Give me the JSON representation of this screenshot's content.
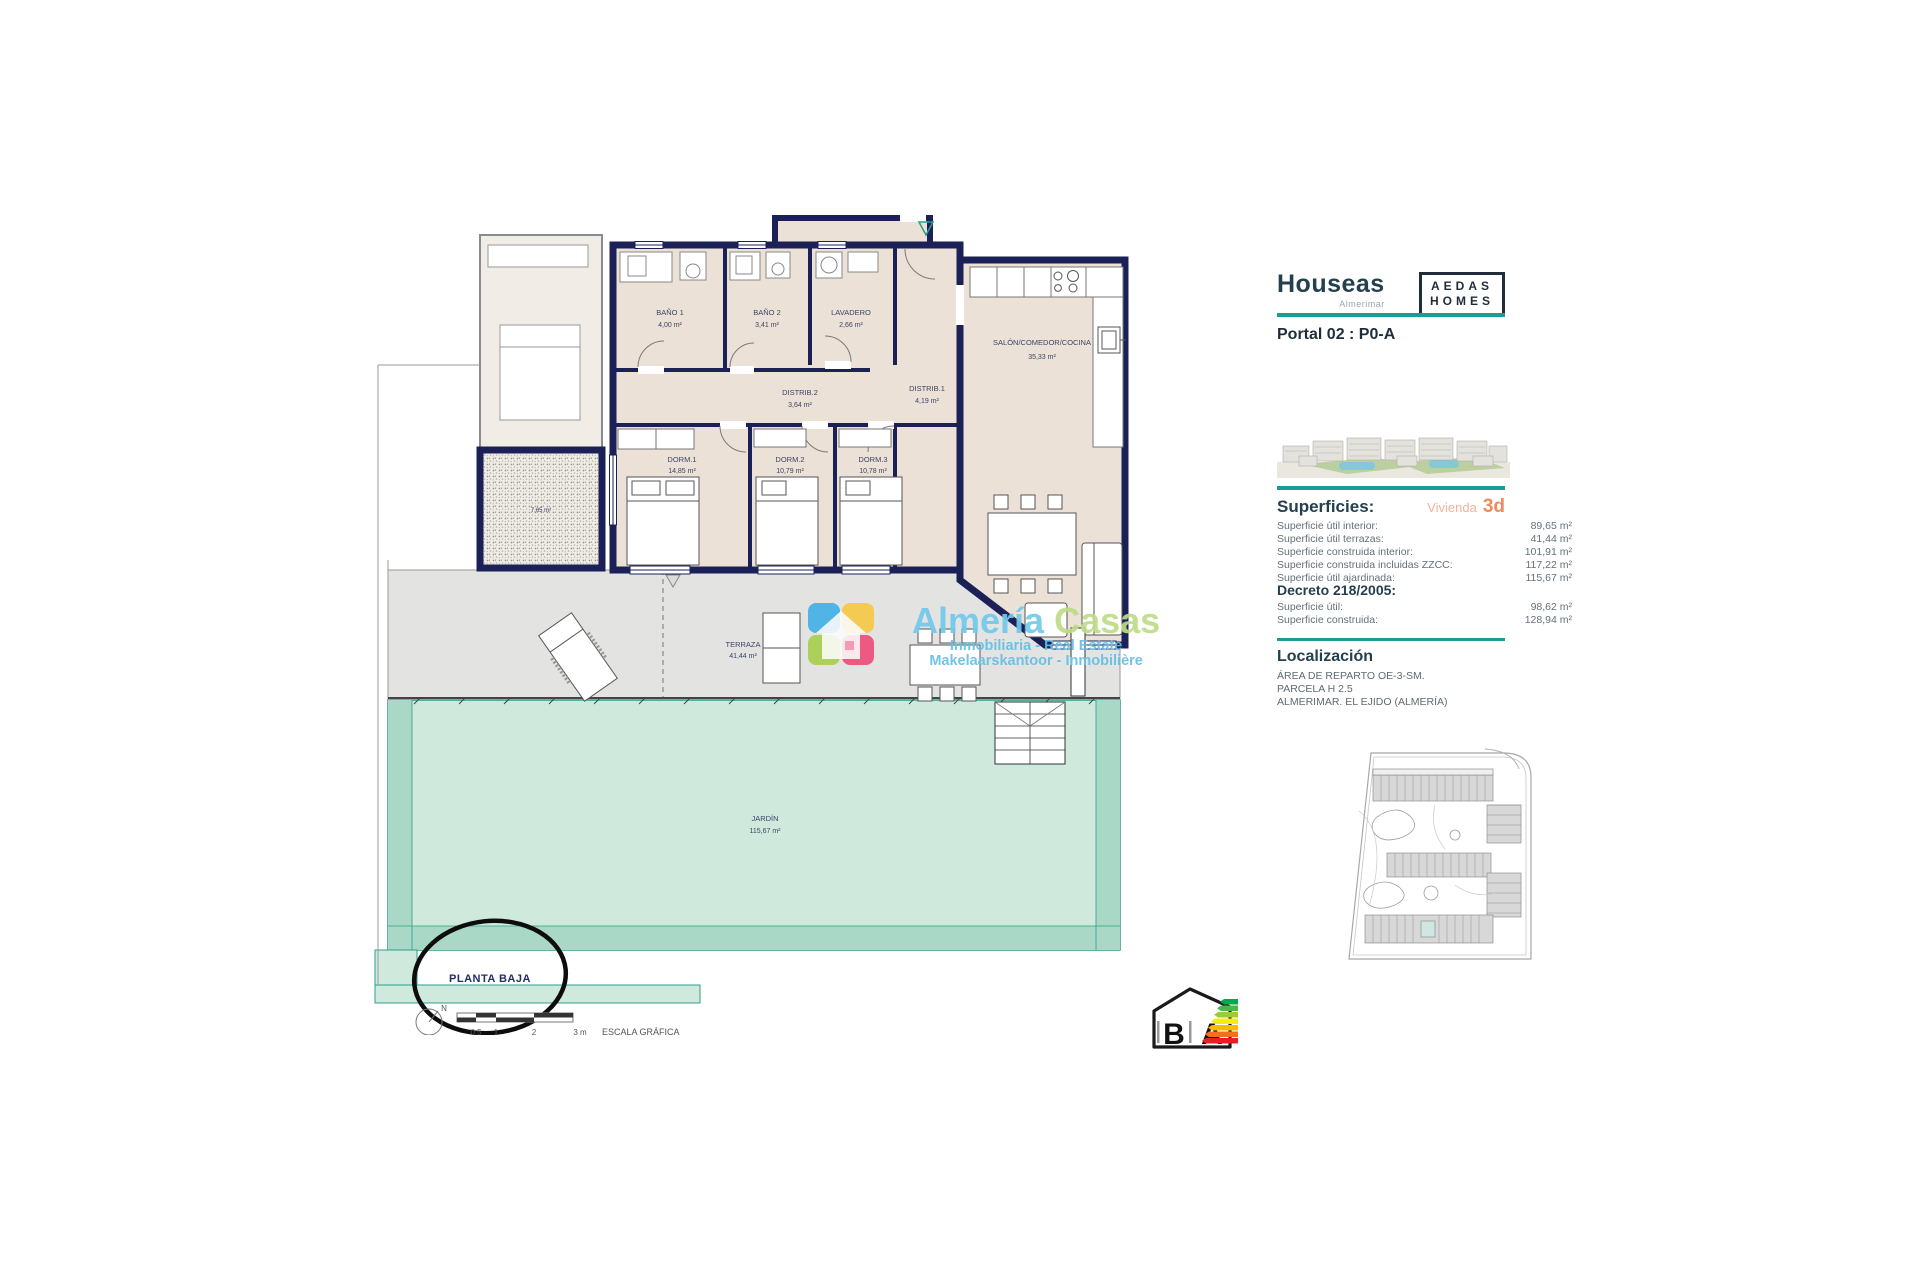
{
  "plan": {
    "rooms": [
      {
        "name": "BAÑO 1",
        "area": "4,00 m²"
      },
      {
        "name": "BAÑO 2",
        "area": "3,41 m²"
      },
      {
        "name": "LAVADERO",
        "area": "2,66 m²"
      },
      {
        "name": "DISTRIB.2",
        "area": "3,64 m²"
      },
      {
        "name": "DISTRIB.1",
        "area": "4,19 m²"
      },
      {
        "name": "DORM.1",
        "area": "14,85 m²"
      },
      {
        "name": "DORM.2",
        "area": "10,79 m²"
      },
      {
        "name": "DORM.3",
        "area": "10,78 m²"
      },
      {
        "name": "SALÓN/COMEDOR/COCINA",
        "area": "35,33 m²"
      },
      {
        "name": "TERRAZA",
        "area": "41,44 m²"
      },
      {
        "name": "JARDÍN",
        "area": "115,67 m²"
      },
      {
        "name": "",
        "area": "7,65 m²"
      }
    ],
    "annotations": {
      "planta_baja": "PLANTA BAJA",
      "escala_grafica": "ESCALA GRÁFICA",
      "north": "N",
      "scale_ticks": [
        "0.5",
        "1",
        "2",
        "3 m"
      ]
    }
  },
  "watermark": {
    "brand1": "Almería",
    "brand2": "Casas",
    "line1": "Inmobiliaria - Real Estate",
    "line2": "Makelaarskantoor - Inmobilière"
  },
  "panel": {
    "brand": "Houseas",
    "brand_sub": "Almerimar",
    "developer": {
      "line1": "AEDAS",
      "line2": "HOMES"
    },
    "portal": "Portal 02 : P0-A",
    "superficies": {
      "title": "Superficies:",
      "vivienda_label": "Vivienda",
      "vivienda_value": "3d",
      "rows": [
        {
          "label": "Superficie útil interior:",
          "value": "89,65 m²"
        },
        {
          "label": "Superficie útil terrazas:",
          "value": "41,44 m²"
        },
        {
          "label": "Superficie construida interior:",
          "value": "101,91 m²"
        },
        {
          "label": "Superficie construida incluidas ZZCC:",
          "value": "117,22 m²"
        },
        {
          "label": "Superficie útil ajardinada:",
          "value": "115,67 m²"
        }
      ]
    },
    "decreto": {
      "title": "Decreto 218/2005:",
      "rows": [
        {
          "label": "Superficie útil:",
          "value": "98,62 m²"
        },
        {
          "label": "Superficie construida:",
          "value": "128,94 m²"
        }
      ]
    },
    "localizacion": {
      "title": "Localización",
      "lines": [
        "ÁREA DE REPARTO OE-3-SM.",
        "PARCELA H 2.5",
        "ALMERIMAR. EL EJIDO (ALMERÍA)"
      ]
    }
  },
  "energy": {
    "letter_b": "B",
    "letter_a": "A"
  },
  "colors": {
    "wall_navy": "#1b2157",
    "interior_beige": "#ebe1d6",
    "terrace_gray": "#e3e3e2",
    "garden_mint": "#cfeadd",
    "garden_dark": "#a9d9c6",
    "accent_teal": "#1d9b9b",
    "accent_orange": "#ee8a5c"
  }
}
